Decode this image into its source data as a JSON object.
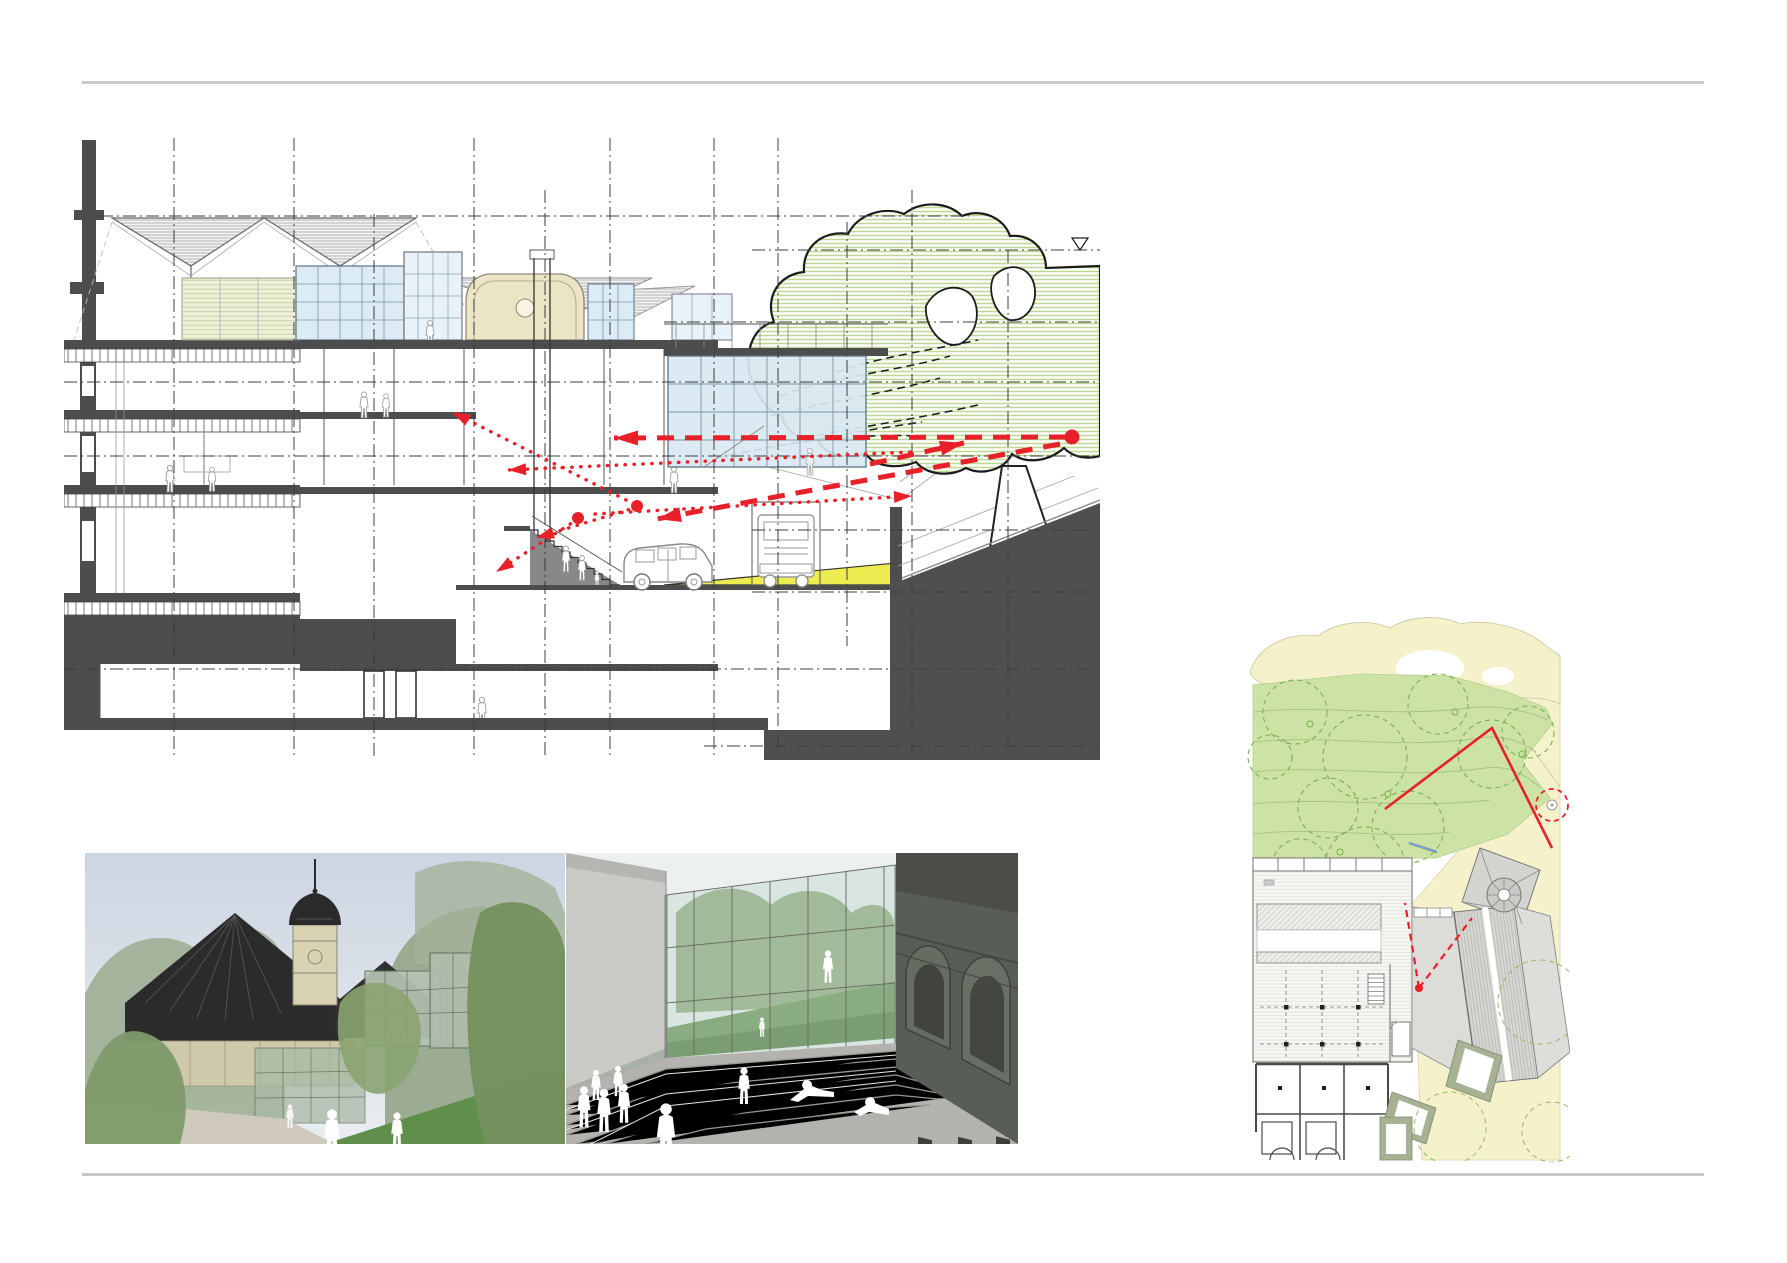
{
  "page": {
    "background": "#ffffff",
    "rule_color": "#c9c9c9",
    "content": "architectural presentation sheet: long building section with red sight-line diagram, two exterior renderings, site plan with red route markings"
  },
  "palette": {
    "poche_dark": "#4d4d4d",
    "line_dark": "#2e2e2e",
    "line_mid": "#8a8a8a",
    "glass_blue": "#dcebf4",
    "glass_stroke": "#5d7181",
    "louver_green": "#eef0da",
    "cream_pavilion": "#ebe5c6",
    "tree_stripe": "#bcd98f",
    "ramp_yellow": "#eded52",
    "accent_red": "#e8202a",
    "plan_yellow": "#f5f2cb",
    "plan_lawn": "#cde2a5",
    "plan_lawn_line": "#a3c47e",
    "plan_tree_dash": "#78b34c",
    "plan_roof_gray": "#d6d6d2",
    "plan_sage": "#a7b294",
    "plan_blue_mark": "#7a9ec2"
  },
  "section": {
    "grid": {
      "verticals": [
        {
          "x": 110,
          "y1": 12,
          "y2": 630
        },
        {
          "x": 230,
          "y1": 12,
          "y2": 630
        },
        {
          "x": 310,
          "y1": 88,
          "y2": 630
        },
        {
          "x": 410,
          "y1": 12,
          "y2": 630
        },
        {
          "x": 481,
          "y1": 64,
          "y2": 630
        },
        {
          "x": 546,
          "y1": 12,
          "y2": 630
        },
        {
          "x": 650,
          "y1": 12,
          "y2": 630
        },
        {
          "x": 714,
          "y1": 12,
          "y2": 630
        },
        {
          "x": 783,
          "y1": 96,
          "y2": 520
        },
        {
          "x": 848,
          "y1": 64,
          "y2": 630
        },
        {
          "x": 944,
          "y1": 124,
          "y2": 630
        }
      ],
      "horizontals": [
        {
          "y": 90,
          "x1": 36,
          "x2": 905
        },
        {
          "y": 124,
          "x1": 688,
          "x2": 1036
        },
        {
          "y": 196,
          "x1": 600,
          "x2": 1036
        },
        {
          "y": 256,
          "x1": 0,
          "x2": 1036
        },
        {
          "y": 330,
          "x1": 0,
          "x2": 1036
        },
        {
          "y": 404,
          "x1": 688,
          "x2": 1036
        },
        {
          "y": 466,
          "x1": 688,
          "x2": 1036
        },
        {
          "y": 543,
          "x1": 0,
          "x2": 1036
        },
        {
          "y": 620,
          "x1": 640,
          "x2": 1036
        }
      ],
      "datum_symbol": {
        "x": 1016,
        "y": 124
      }
    },
    "red_overlay": {
      "color": "#e8202a",
      "dots": [
        {
          "x": 514,
          "y": 392,
          "r": 6
        },
        {
          "x": 573,
          "y": 380,
          "r": 6
        },
        {
          "x": 1008,
          "y": 311,
          "r": 7.5
        }
      ],
      "dashed_arrows": [
        {
          "x1": 1002,
          "y1": 311,
          "x2": 550,
          "y2": 312
        },
        {
          "x1": 996,
          "y1": 318,
          "x2": 593,
          "y2": 393
        },
        {
          "x1": 806,
          "y1": 338,
          "x2": 900,
          "y2": 317
        }
      ],
      "dotted_arrows": [
        {
          "x1": 531,
          "y1": 388,
          "x2": 848,
          "y2": 370
        },
        {
          "x1": 846,
          "y1": 326,
          "x2": 444,
          "y2": 344
        },
        {
          "x1": 573,
          "y1": 381,
          "x2": 472,
          "y2": 412
        },
        {
          "x1": 514,
          "y1": 393,
          "x2": 432,
          "y2": 446
        },
        {
          "x1": 570,
          "y1": 378,
          "x2": 388,
          "y2": 286
        }
      ]
    }
  },
  "site_plan": {
    "red_route": [
      [
        145,
        197
      ],
      [
        252,
        116
      ],
      [
        312,
        236
      ]
    ],
    "viewpoint": {
      "dot": [
        179,
        376
      ],
      "rays": [
        [
          165,
          291
        ],
        [
          232,
          306
        ]
      ]
    },
    "red_dashed_circle": {
      "cx": 312,
      "cy": 193,
      "r": 16
    },
    "blue_mark": [
      [
        169,
        231
      ],
      [
        197,
        240
      ]
    ]
  },
  "renderings": [
    {
      "name": "view of historic chateau with dark hipped roofs, clock tower and new glass extension among trees"
    },
    {
      "name": "view across broad stone steps between glass hall with green hill behind and dark arched stone facade"
    }
  ]
}
